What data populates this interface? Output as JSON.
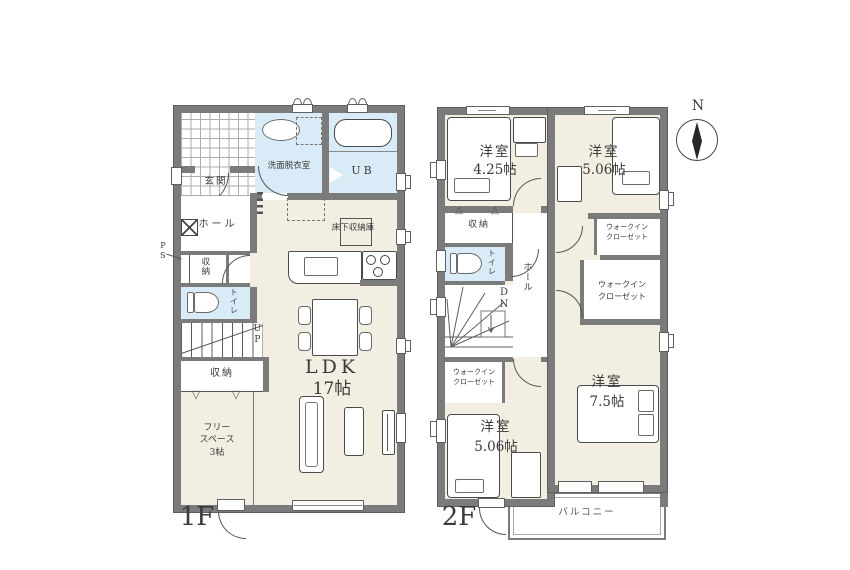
{
  "colors": {
    "wall": "#7b7b7b",
    "room_fill": "#f2efe2",
    "wet_fill": "#d9ebf6"
  },
  "f1": {
    "label": "1F",
    "genkan": "玄関",
    "hall": "ホール",
    "senmen": "洗面脱衣室",
    "ub": "UB",
    "yukashita": "床下収納庫",
    "ldk_name": "LDK",
    "ldk_size": "17帖",
    "toilet": "トイレ",
    "storage_a": "収納",
    "storage_b": "収納",
    "free_l1": "フリー",
    "free_l2": "スペース",
    "free_l3": "3帖",
    "up": "UP",
    "ps": "PS"
  },
  "f2": {
    "label": "2F",
    "room_nw": {
      "name": "洋室",
      "size": "4.25帖"
    },
    "room_ne": {
      "name": "洋室",
      "size": "5.06帖"
    },
    "room_sw": {
      "name": "洋室",
      "size": "5.06帖"
    },
    "room_se": {
      "name": "洋室",
      "size": "7.5帖"
    },
    "wic_ne": {
      "l1": "ウォークイン",
      "l2": "クローゼット"
    },
    "wic_e": {
      "l1": "ウォークイン",
      "l2": "クローゼット"
    },
    "wic_sw": {
      "l1": "ウォークイン",
      "l2": "クローゼット"
    },
    "storage": "収納",
    "toilet": "トイレ",
    "hall": "ホール",
    "dn": "DN",
    "balcony": "バルコニー"
  },
  "compass": {
    "north": "N"
  },
  "symbols": {
    "fold_down": "▽",
    "fold_up": "△"
  }
}
